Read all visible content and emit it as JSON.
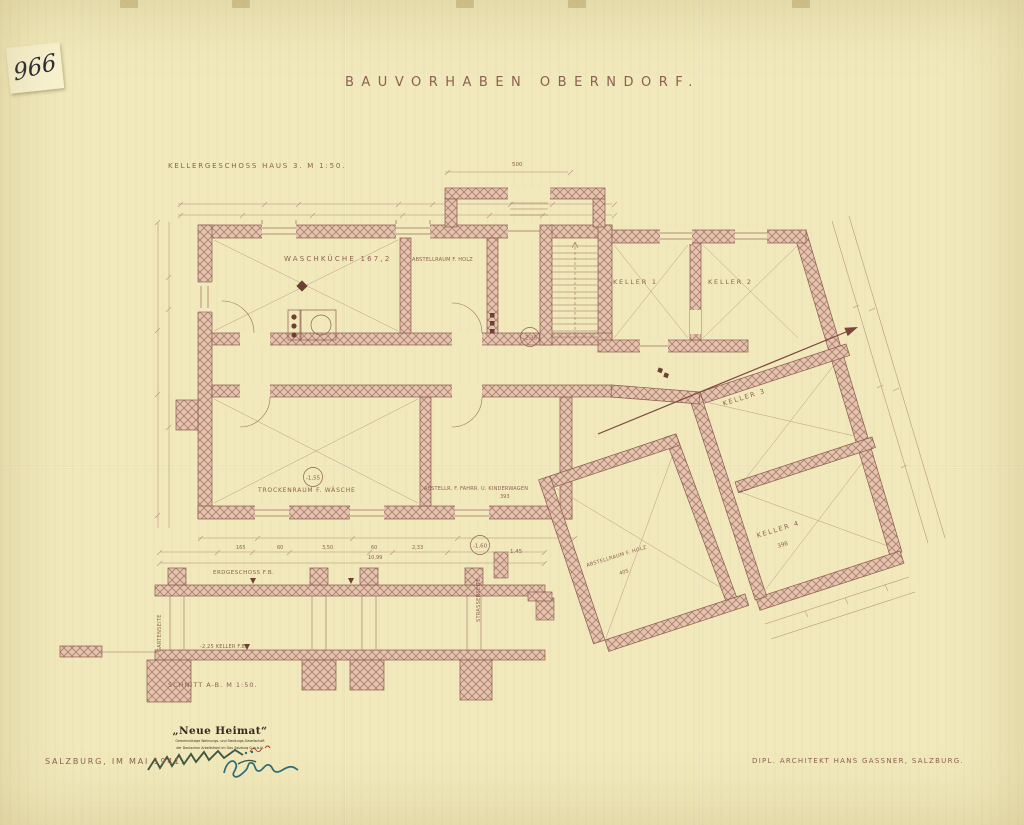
{
  "page": {
    "archive_number": "966",
    "title": "BAUVORHABEN OBERNDORF.",
    "date_line": "SALZBURG, IM MAI 1941.",
    "architect_line": "DIPL. ARCHITEKT HANS GASSNER, SALZBURG."
  },
  "plan": {
    "label": "KELLERGESCHOSS HAUS 3. M 1:50.",
    "rooms": {
      "waschkueche": "WASCHKÜCHE 167,2",
      "abstellraum_holz": "ABSTELLRAUM F. HOLZ",
      "keller1": "KELLER 1",
      "keller2": "KELLER 2",
      "keller3": "KELLER 3",
      "keller4": "KELLER 4",
      "trockenraum": "TROCKENRAUM F. WÄSCHE",
      "abstellr_fahrr": "ABSTELLR. F. FAHRR. U. KINDERWAGEN",
      "abstellraum_holz_2": "ABSTELLRAUM F. HOLZ"
    },
    "dims": {
      "top_total": "500",
      "keller4": "398",
      "abstellraum_holz_2": "405",
      "abstellr_fahrr": "393",
      "street": "1,45"
    },
    "levels": {
      "stair": "-2,35",
      "trockenraum": "-1,55",
      "street": "-1,60"
    }
  },
  "section": {
    "label": "SCHNITT A-B. M 1:50.",
    "floor_upper": "ERDGESCHOSS F.B.",
    "floor_lower": "-2,25 KELLER F.B.",
    "side_left": "GARTENSEITE",
    "side_right": "STRASSENSEITE",
    "dims": [
      "165",
      "60",
      "3,50",
      "60",
      "2,33"
    ],
    "total": "10,99"
  },
  "stamp": {
    "line1": "„Neue Heimat“",
    "line2": "Gemeinnützige Wohnungs- und Siedlungs-Gesellschaft",
    "line3": "der Deutschen Arbeitsfront im Gau Salzburg G.m.b.H."
  },
  "colors": {
    "paper": "#f1e9bb",
    "ink": "#8d5f50",
    "wall_fill": "#e3c4ae",
    "hatch": "#ad7a6b",
    "stamp_ink": "#352a20",
    "signature_green": "#2c4a38",
    "signature_teal": "#2f6d78",
    "stamp_red": "#b03a2a"
  }
}
